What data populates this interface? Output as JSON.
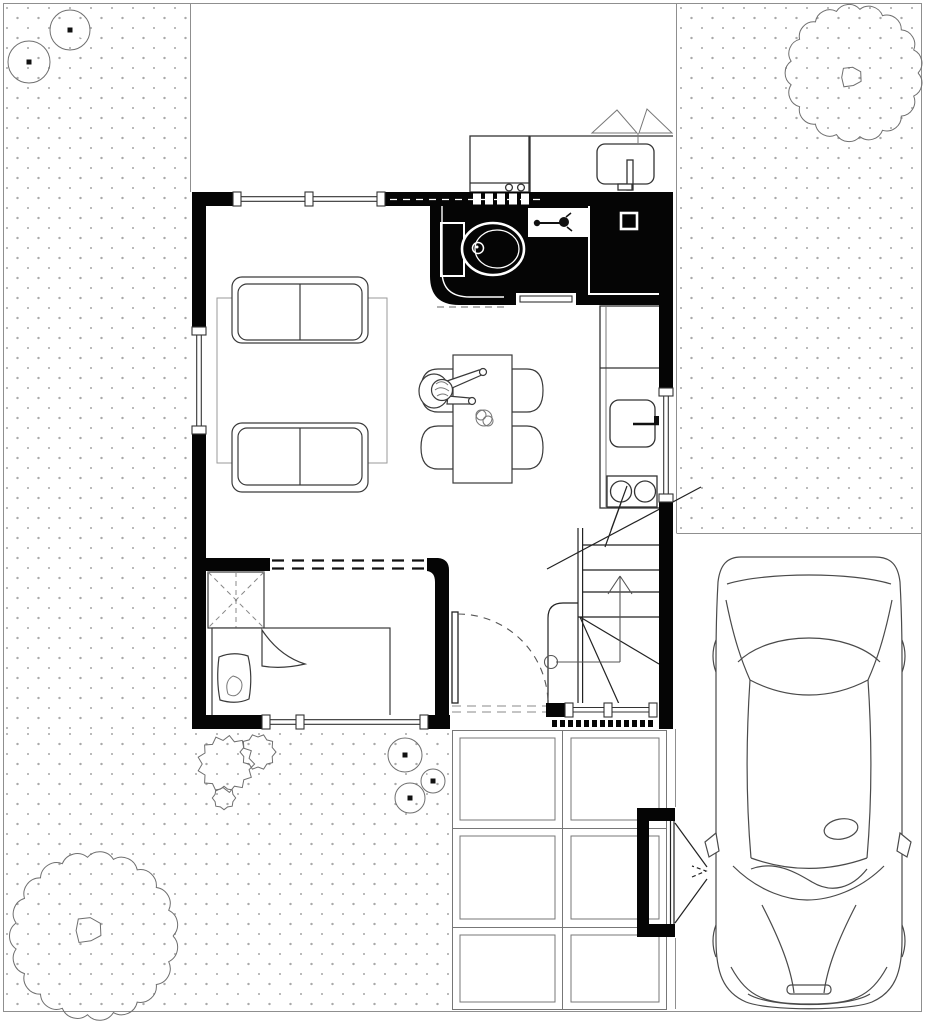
{
  "meta": {
    "kind": "architectural-ground-floor-plan-with-site",
    "width_px": 929,
    "height_px": 1024,
    "background": "#ffffff"
  },
  "palette": {
    "wall": "#050505",
    "line_dark": "#2e2e2e",
    "line_mid": "#555555",
    "line_light": "#8f8f8f",
    "stipple_dot": "#a9a9a9",
    "paper": "#ffffff"
  },
  "aria": {
    "stage": "Ground floor plan with site, car and garden",
    "plan": "Floor plan of small house",
    "car": "Car parked on driveway, top view",
    "stairs": "Winder staircase going up",
    "path": "Paved walkway of square slabs",
    "gate": "Entrance gate to driveway"
  },
  "site": {
    "ground_texture": "stippled-dots",
    "trees_large_scalloped": 2,
    "bushes_notched_round": 5,
    "bushes_spiky": 3,
    "paver_grid": {
      "columns": 2,
      "rows": 3
    },
    "car_count": 1,
    "gate_count": 1
  },
  "plan": {
    "rooms": [
      "living-dining-room",
      "kitchen",
      "bathroom",
      "bedroom",
      "hall-with-stairs",
      "laundry-patio"
    ],
    "fixtures": [
      "toilet",
      "bathroom-sink",
      "shower",
      "kitchen-sink",
      "stove-2-burners",
      "counter-fridge",
      "washing-machine",
      "laundry-basin"
    ],
    "furniture": [
      "sofa-two-seat",
      "sofa-two-seat",
      "rug",
      "dining-table",
      "dining-chairs-4",
      "person-seated",
      "table-plant",
      "bed-single",
      "pillow",
      "wardrobe"
    ],
    "openings": [
      "front-door-with-swing",
      "window-living-north",
      "window-living-west",
      "window-kitchen-east",
      "window-bedroom-south",
      "bedroom-cased-opening",
      "bathroom-sliding-door",
      "entry-sill",
      "stair-up-arrow"
    ]
  }
}
